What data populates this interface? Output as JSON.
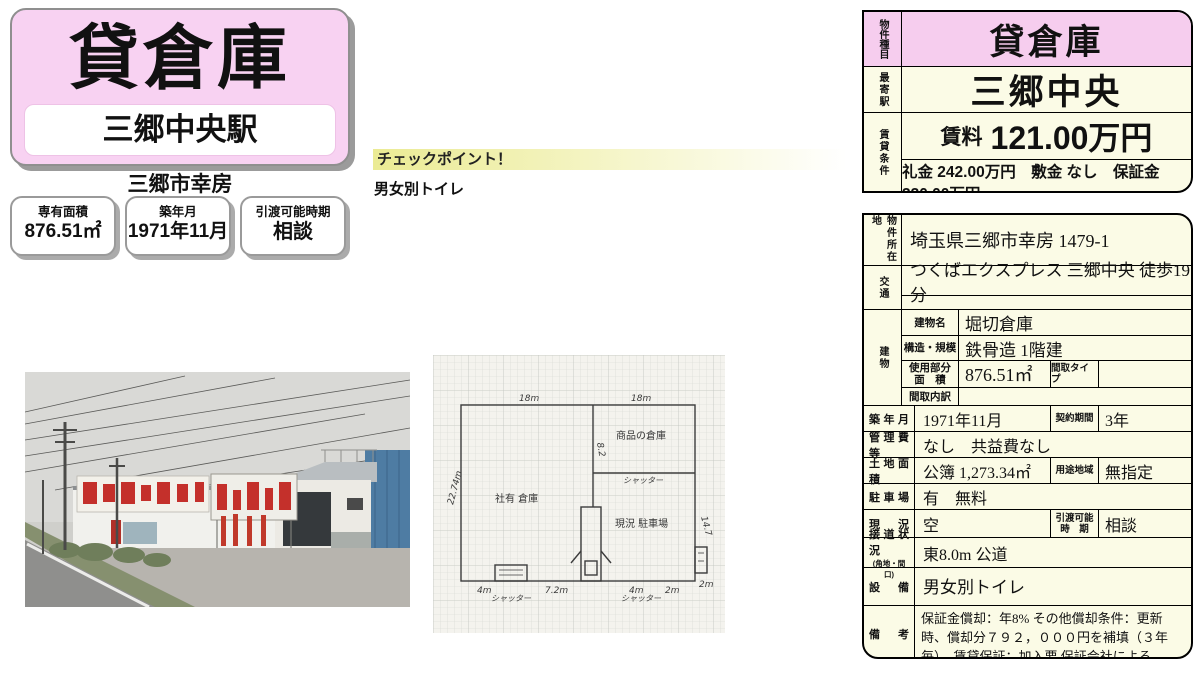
{
  "title_card": {
    "title": "貸倉庫",
    "station": "三郷中央駅",
    "city": "三郷市幸房"
  },
  "chips": [
    {
      "label": "専有面積",
      "value": "876.51㎡"
    },
    {
      "label": "築年月",
      "value": "1971年11月"
    },
    {
      "label": "引渡可能時期",
      "value": "相談"
    }
  ],
  "checkpoint": {
    "heading": "チェックポイント！",
    "note": "男女別トイレ"
  },
  "summary_table": {
    "type_label": "物件種目",
    "type_value": "貸倉庫",
    "station_label": "最寄駅",
    "station_value": "三郷中央",
    "cond_label": "賃貸条件",
    "rent_label": "賃料",
    "rent_value": "121.00万円",
    "fees": "礼金 242.00万円　敷金 なし　保証金 330.00万円"
  },
  "detail_table": {
    "location_label": "物件所在地",
    "location": "埼玉県三郷市幸房 1479-1",
    "access_label": "交通",
    "access": "つくばエクスプレス 三郷中央 徒歩19分",
    "building_label": "建物",
    "building_name_label": "建物名",
    "building_name": "堀切倉庫",
    "structure_label": "構造・規模",
    "structure": "鉄骨造 1階建",
    "use_area_label1": "使用部分",
    "use_area_label2": "面　積",
    "use_area": "876.51㎡",
    "plan_type_label": "間取タイプ",
    "plan_type": "",
    "plan_detail_label": "間取内訳",
    "plan_detail": "",
    "built_label": "築年月",
    "built": "1971年11月",
    "contract_label": "契約期間",
    "contract": "3年",
    "mgmt_label": "管理費等",
    "mgmt": "なし　共益費なし",
    "land_label": "土地面積",
    "land": "公簿 1,273.34㎡",
    "zoning_label": "用途地域",
    "zoning": "無指定",
    "parking_label": "駐車場",
    "parking": "有　無料",
    "status_label": "現況",
    "status": "空",
    "handover_label1": "引渡可能",
    "handover_label2": "時　期",
    "handover": "相談",
    "road_label": "接道状況",
    "road_label2": "(角地・間口)",
    "road": "東8.0m 公道",
    "equip_label": "設備",
    "equip": "男女別トイレ",
    "notes_label": "備考",
    "notes": "保証金償却：年8% その他償却条件：更新時、償却分７９２，０００円を補填（３年毎）　賃貸保証：加入要 保証会社による"
  },
  "floorplan": {
    "dims": {
      "top_left": "18m",
      "top_right": "18m",
      "left": "22.74m",
      "divider": "8.2",
      "right": "14.7",
      "bottom_1": "4m",
      "bottom_2": "7.2m",
      "bottom_3": "4m",
      "bottom_4": "2m",
      "bottom_5": "2m"
    },
    "rooms": {
      "storage": "商品の倉庫",
      "left_area": "社有 倉庫",
      "parking": "現況 駐車場"
    },
    "shutters": {
      "mid": "シャッター",
      "bottom_left": "シャッター",
      "bottom_right": "シャッター"
    }
  }
}
